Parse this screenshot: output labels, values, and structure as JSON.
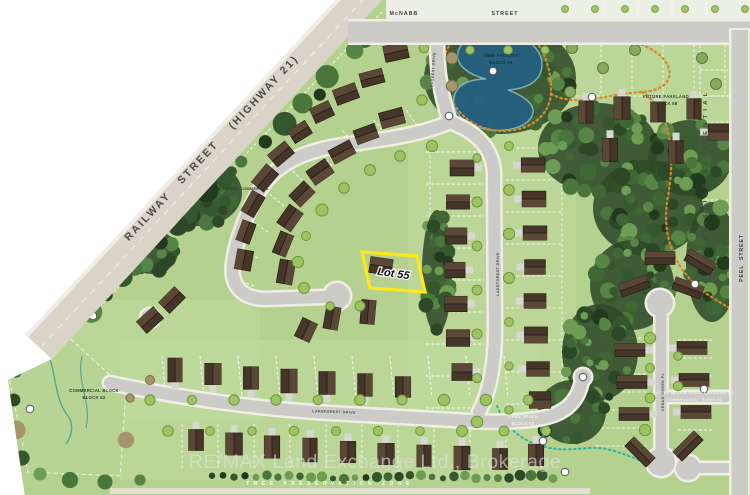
{
  "map": {
    "watermark": "RE/MAX Land Exchange Ltd., Brokerage",
    "streets": {
      "railway": "RAILWAY   STREET    (HIGHWAY 21)",
      "mcnabb_name": "McNABB",
      "mcnabb_type": "STREET",
      "peel": "PEEL  STREET",
      "lakeforest": "LAKEFOREST DRIVE",
      "cedar_creek": "CEDAR CREEK PL"
    },
    "areas": {
      "existing_residential": "EXISTING RESIDENTIAL",
      "swm_1": "SWM FACILITY",
      "swm_2": "BLOCK 59",
      "parkland_1": "FUTURE PARKLAND",
      "parkland_2": "BLOCK 58",
      "existing_commercial": "EXISTING COMMERCIAL",
      "commercial_1": "COMMERCIAL BLOCK",
      "commercial_2": "BLOCK 62",
      "open_space_1": "OPEN SPACE",
      "open_space_2": "BLOCK 60",
      "townhouse_1": "FUTURE MEDIUM DENSITY RESIDENTIAL",
      "townhouse_2": "(TOWNHOUSES)   BLOCK 66",
      "tree_preservation": "TREE PRESERVATION ZONE"
    },
    "highlight": {
      "label": "Lot 55",
      "color": "#ffe81a"
    },
    "colors": {
      "grass": "#b5d190",
      "grass_light": "#c6dfa6",
      "commercial_fill": "#b7d495",
      "road": "#cbcbc7",
      "road_casing": "#f0ede5",
      "railway_road": "#d9d3c8",
      "forest_base": "#2f4a28",
      "pond": "#26607f",
      "pond_edge": "#7fb2c0",
      "trail_orange": "#d88a28",
      "trail_teal": "#2cb4a4",
      "house": "#46362a",
      "house_roof_light": "#5a4736",
      "house_outline": "#211812",
      "driveway": "#d8d8d2",
      "tree_street": "#9dc460",
      "tree_street_stroke": "#6e9542",
      "tree_tan": "#a6956c",
      "tree_tan_stroke": "#7a6c4e",
      "stream": "#3f9e98",
      "watermark": "rgba(222,226,224,0.62)"
    }
  }
}
